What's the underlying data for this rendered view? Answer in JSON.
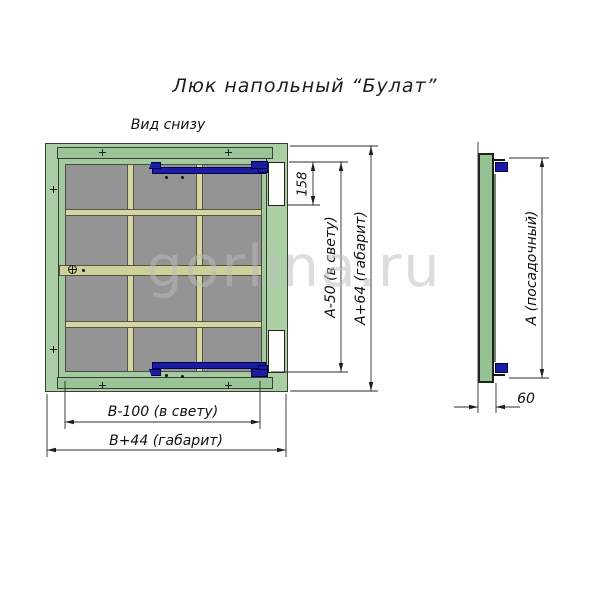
{
  "title": "Люк напольный “Булат”",
  "view_label": "Вид снизу",
  "watermark": "gorlina.ru",
  "dimensions": {
    "latch_offset": "158",
    "clear_height": "А-50 (в свету)",
    "overall_height": "А+64 (габарит)",
    "clear_width": "В-100 (в свету)",
    "overall_width": "В+44 (габарит)",
    "seat_size": "А (посадочный)",
    "frame_depth": "60"
  },
  "colors": {
    "frame-green": "#abcfa5",
    "flange-green": "#9ac497",
    "lid-green": "#a3ca9e",
    "panel-gray": "#949494",
    "rib-khaki": "#d6d6a4",
    "hinge-navy": "#1c1ca0"
  }
}
